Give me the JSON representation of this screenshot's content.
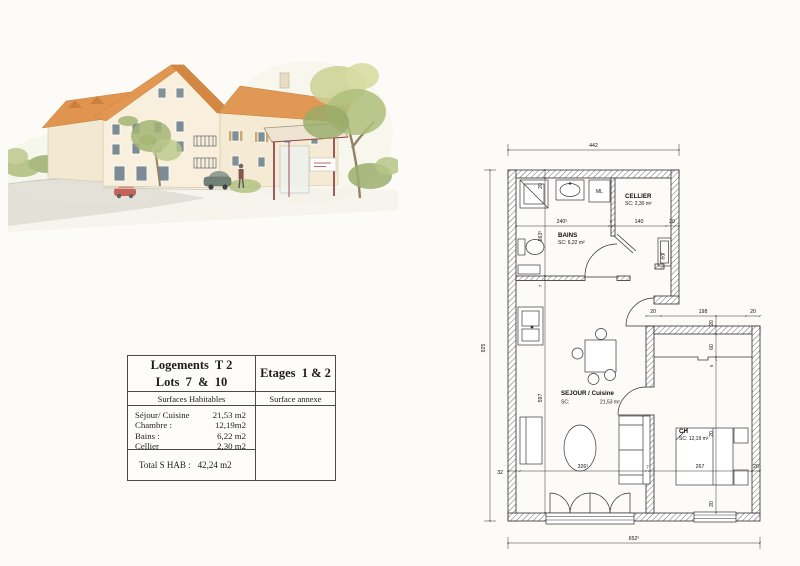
{
  "illustration": {
    "alt": "Watercolor sketch of the residence with trees and bus shelter"
  },
  "info_table": {
    "title_left_line1": "Logements  T 2",
    "title_left_line2": "Lots  7  &  10",
    "title_right": "Etages  1 & 2",
    "col_left_header": "Surfaces Habitables",
    "col_right_header": "Surface annexe",
    "rows": [
      {
        "label": "Séjour/ Cuisine",
        "value": "21,53 m2"
      },
      {
        "label": "Chambre :",
        "value": "12,19m2"
      },
      {
        "label": "Bains :",
        "value": "6,22 m2"
      },
      {
        "label": "Cellier",
        "value": "2,30 m2"
      }
    ],
    "total_label": "Total  S HAB :",
    "total_value": "42,24 m2"
  },
  "floor_plan": {
    "overall": {
      "top": "442",
      "left": "925",
      "bottom": "652⁵"
    },
    "rooms": {
      "bains": {
        "name": "BAINS",
        "area": "SC: 6,22 m²"
      },
      "cellier": {
        "name": "CELLIER",
        "area": "SC: 2,30 m²"
      },
      "sejour": {
        "name": "SEJOUR  /  Cuisine",
        "sc_label": "SC:",
        "area": "21,53 m²"
      },
      "chambre": {
        "name": "CH",
        "area": "SC: 12,19 m²"
      }
    },
    "equipment": {
      "ml": "ML",
      "edf": "edf"
    },
    "dims": {
      "bains_line": [
        "240⁵",
        "7",
        "140",
        "20"
      ],
      "bottom_line": [
        "32",
        "326⁵",
        "7",
        "267",
        "20"
      ],
      "hall_line": [
        "20",
        "198",
        "20"
      ],
      "left_line": [
        "20",
        "263⁵",
        "7",
        "597"
      ],
      "right_line": [
        "20",
        "60",
        "5",
        "20",
        "20"
      ]
    }
  }
}
